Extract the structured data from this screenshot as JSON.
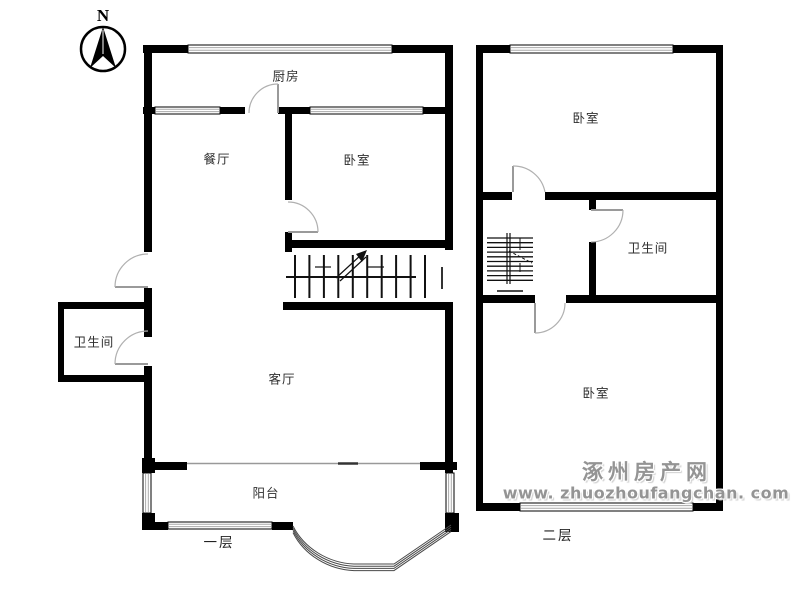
{
  "compass": {
    "north_label": "N"
  },
  "first_floor": {
    "floor_label": "一层",
    "kitchen": "厨房",
    "dining_room": "餐厅",
    "bedroom": "卧室",
    "bathroom": "卫生间",
    "living_room": "客厅",
    "balcony": "阳台"
  },
  "second_floor": {
    "floor_label": "二层",
    "bedroom_top": "卧室",
    "bathroom": "卫生间",
    "bedroom_bottom": "卧室"
  },
  "watermark": {
    "site_name": "涿州房产网",
    "site_url": "www. zhuozhoufangchan. com"
  },
  "colors": {
    "wall": "#000000",
    "door_line": "#9a9a9a",
    "watermark": "#949494"
  }
}
